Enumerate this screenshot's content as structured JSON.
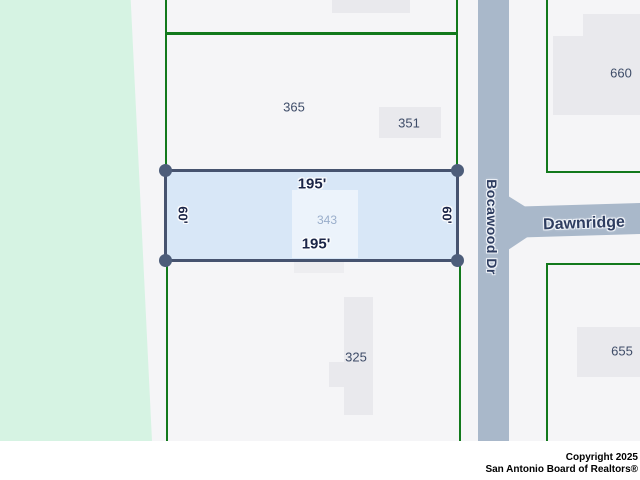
{
  "map": {
    "subject_lot": {
      "number": "343",
      "top_dimension": "195'",
      "bottom_dimension": "195'",
      "left_dimension": "60'",
      "right_dimension": "60'"
    },
    "streets": {
      "vertical_name": "Bocawood Dr",
      "horizontal_name": "Dawnridge"
    },
    "neighbor_lots": {
      "north": "365",
      "north_building": "351",
      "south": "325",
      "east_north": "660",
      "east_south": "655"
    },
    "colors": {
      "greenbelt_fill": "#d6f3e3",
      "parcel_line_green": "#12791c",
      "street_fill": "#a9b8ca",
      "subject_lot_fill": "#d8e7f7",
      "subject_lot_border": "#46536f",
      "building_footprint_fill": "#e9e9ed",
      "dimension_text": "#1b2547",
      "lot_number_text": "#3e4c68"
    }
  },
  "footer": {
    "copyright_line1": "Copyright 2025",
    "copyright_line2": "San Antonio Board of Realtors®"
  }
}
